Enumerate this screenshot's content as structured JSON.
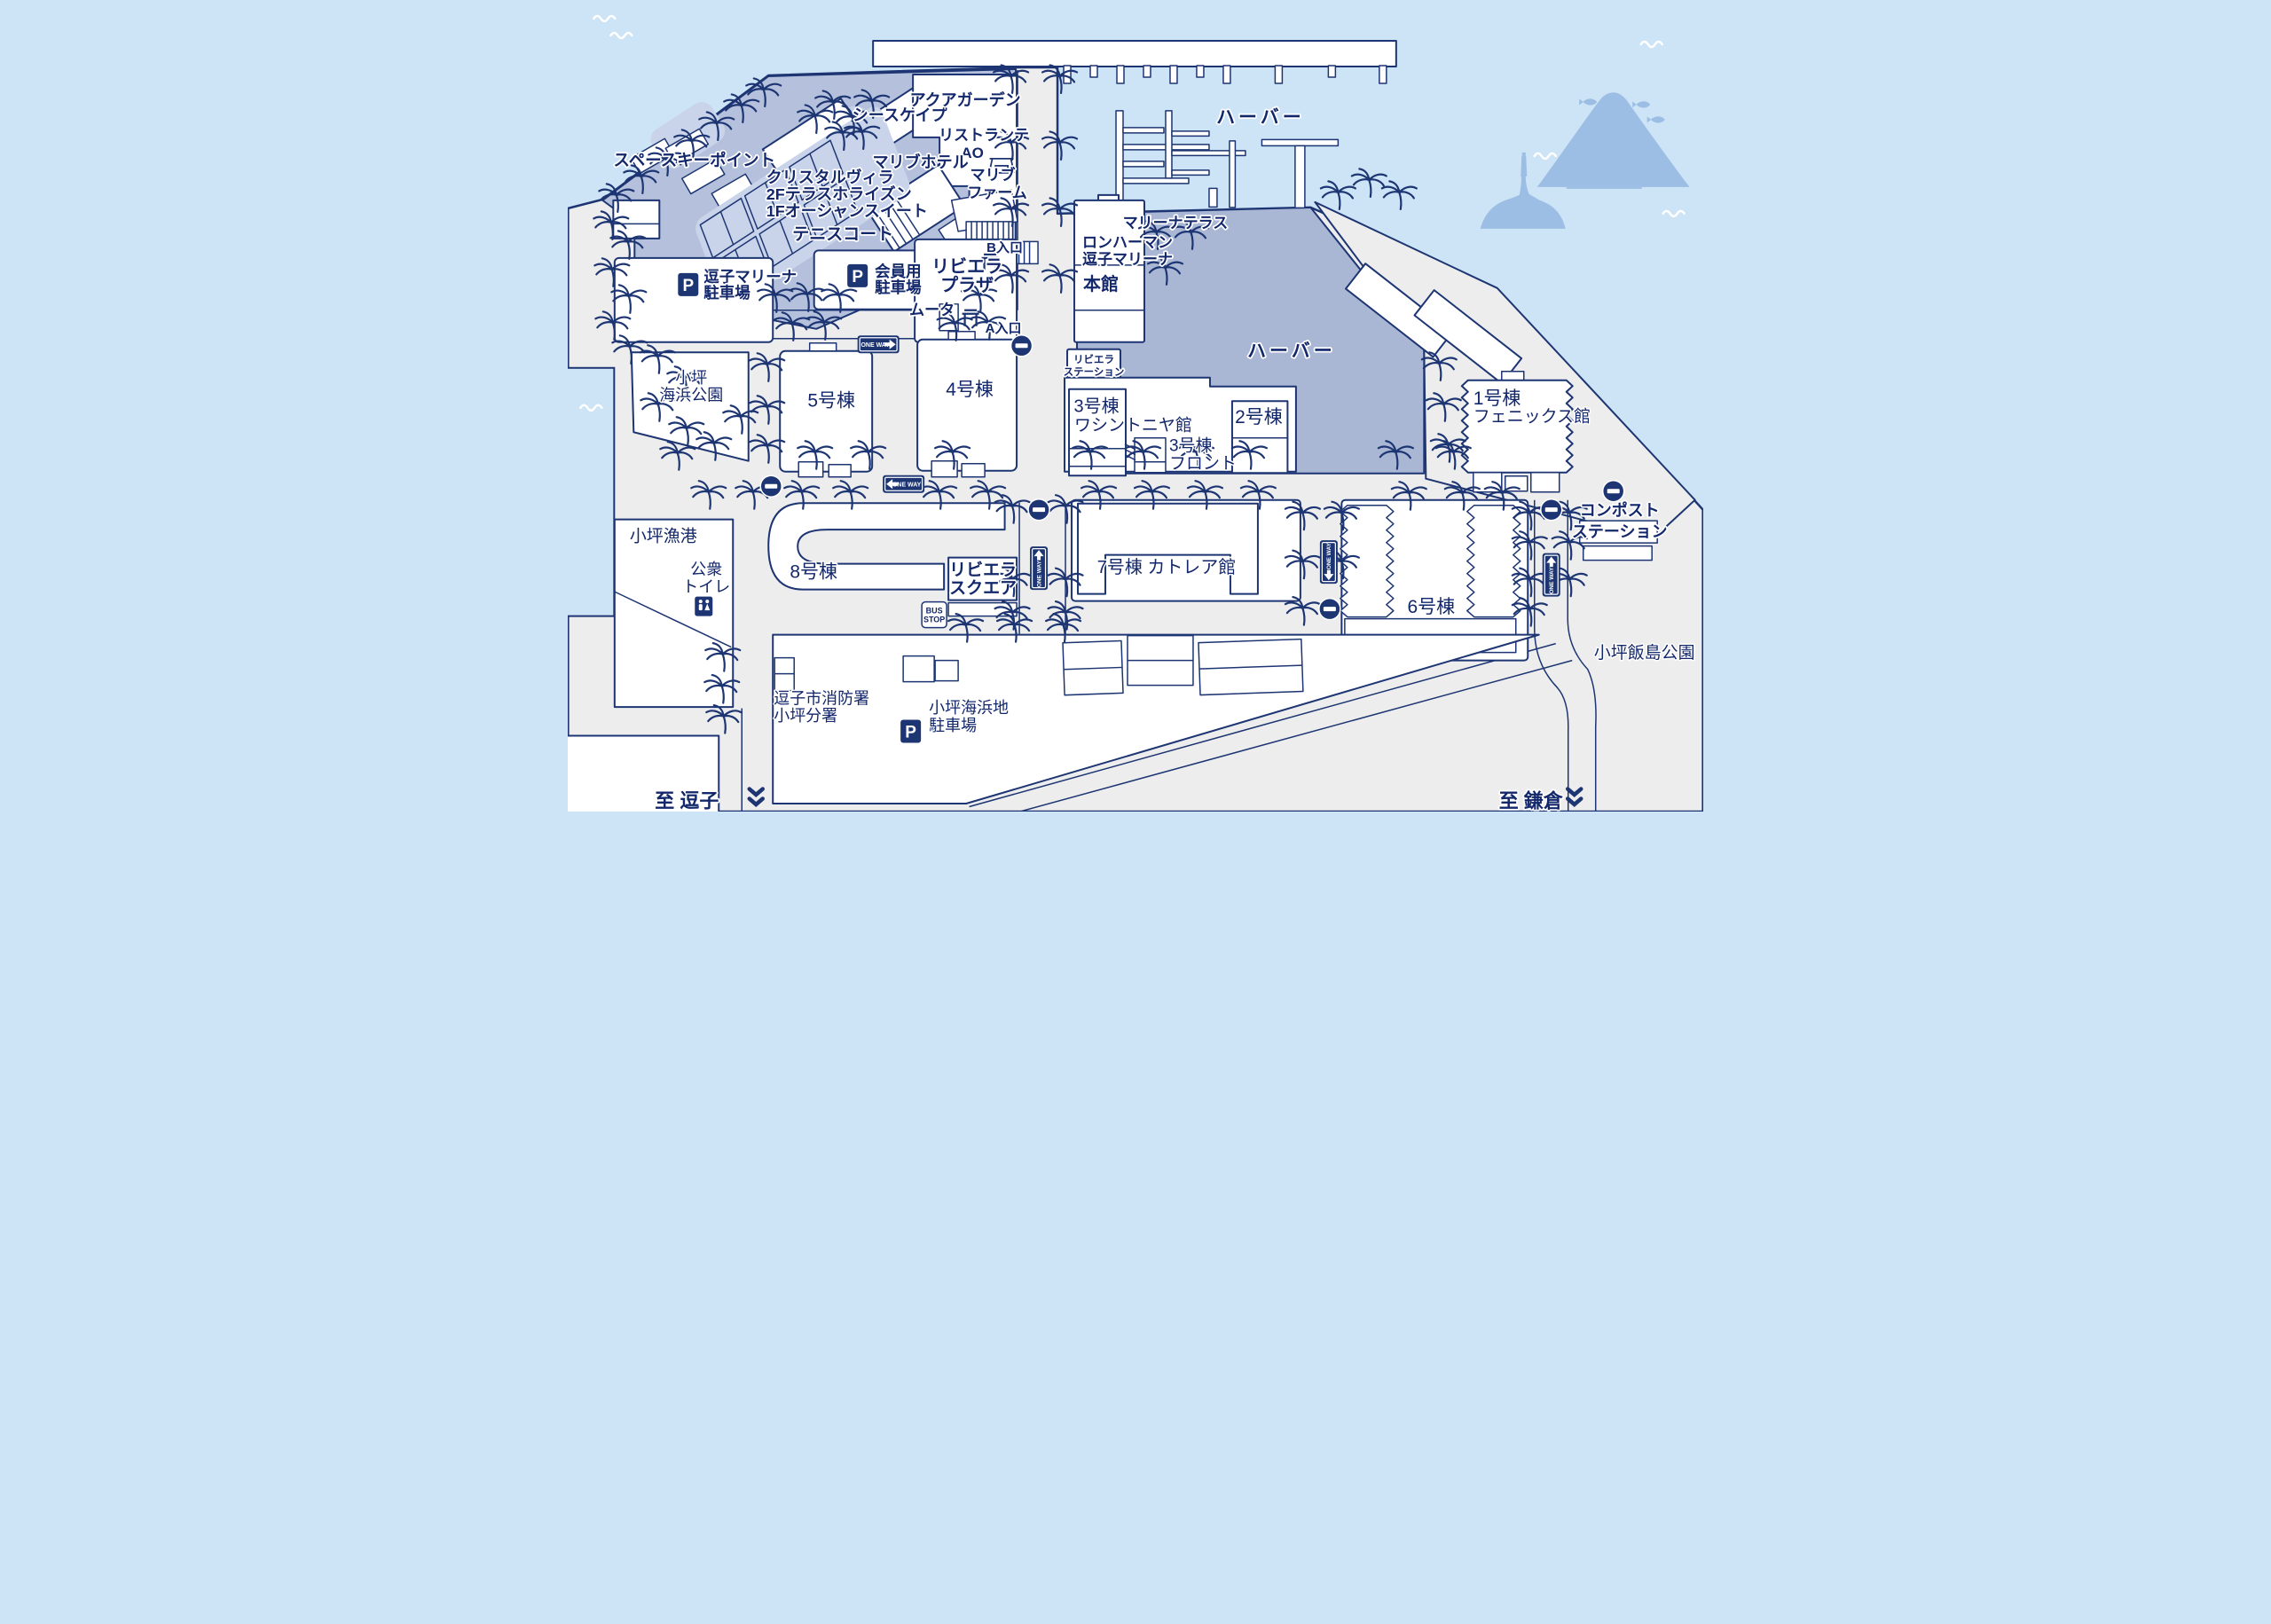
{
  "map_name": "zushi-marina-resort-map",
  "colors": {
    "sea": "#cde4f6",
    "land": "#ededee",
    "resort_core": "#b5c1dc",
    "harbor_deck": "#a9b7d5",
    "light_area": "#c9d4ea",
    "outline": "#1d3572",
    "label_text": "#13276b",
    "silhouette": "#9cbde4",
    "sign_blue": "#1d3572"
  },
  "icons": [
    "palm-tree-icon",
    "no-entry-icon",
    "one-way-sign",
    "parking-icon",
    "bus-stop-sign",
    "restroom-icon",
    "gate-icon",
    "chevron-double-icon",
    "fish-icon",
    "wave-icon",
    "mount-fuji-silhouette",
    "lighthouse-island-silhouette",
    "table-icon"
  ],
  "signs": {
    "one_way": "ONE WAY",
    "bus_l1": "BUS",
    "bus_l2": "STOP",
    "parking": "P"
  },
  "labels": {
    "space_key_point": "スペースキーポイント",
    "crystal_villa_l1": "クリスタルヴィラ",
    "crystal_villa_l2": "2Fテラスホライズン",
    "crystal_villa_l3": "1Fオーシャンスイート",
    "seascape": "シースケイプ",
    "aqua_garden": "アクアガーデン",
    "ristorante_l1": "リストランテ",
    "ristorante_l2": "AO",
    "malibu_hotel": "マリブホテル",
    "malibu_farm_l1": "マリブ",
    "malibu_farm_l2": "ファーム",
    "tennis_court": "テニスコート",
    "marina_parking_l1": "逗子マリーナ",
    "marina_parking_l2": "駐車場",
    "member_parking_l1": "会員用",
    "member_parking_l2": "駐車場",
    "riviera_plaza_l1": "リビエラ",
    "riviera_plaza_l2": "プラザ",
    "muta": "ムータ",
    "entrance_b": "B入口",
    "entrance_a": "A入口",
    "harbor_north": "ハーバー",
    "harbor_center": "ハーバー",
    "marina_terrace": "マリーナテラス",
    "ron_herman_l1": "ロンハーマン",
    "ron_herman_l2": "逗子マリーナ",
    "main_building": "本館",
    "riviera_station_l1": "リビエラ",
    "riviera_station_l2": "ステーション",
    "kotsubo_park_l1": "小坪",
    "kotsubo_park_l2": "海浜公園",
    "bldg5": "5号棟",
    "bldg4": "4号棟",
    "bldg3_l1": "3号棟",
    "bldg3_l2": "ワシントニヤ館",
    "bldg3_front_l1": "3号棟",
    "bldg3_front_l2": "フロント",
    "bldg2": "2号棟",
    "bldg1_l1": "1号棟",
    "bldg1_l2": "フェニックス館",
    "compost_l1": "コンポスト",
    "compost_l2": "ステーション",
    "kotsubo_fishing_port": "小坪漁港",
    "public_toilet_l1": "公衆",
    "public_toilet_l2": "トイレ",
    "bldg8": "8号棟",
    "riviera_square_l1": "リビエラ",
    "riviera_square_l2": "スクエア",
    "bldg7": "7号棟 カトレア館",
    "bldg6": "6号棟",
    "iijima_park": "小坪飯島公園",
    "fire_station_l1": "逗子市消防署",
    "fire_station_l2": "小坪分署",
    "seaside_parking_l1": "小坪海浜地",
    "seaside_parking_l2": "駐車場",
    "to_zushi": "至 逗子",
    "to_kamakura": "至 鎌倉"
  }
}
